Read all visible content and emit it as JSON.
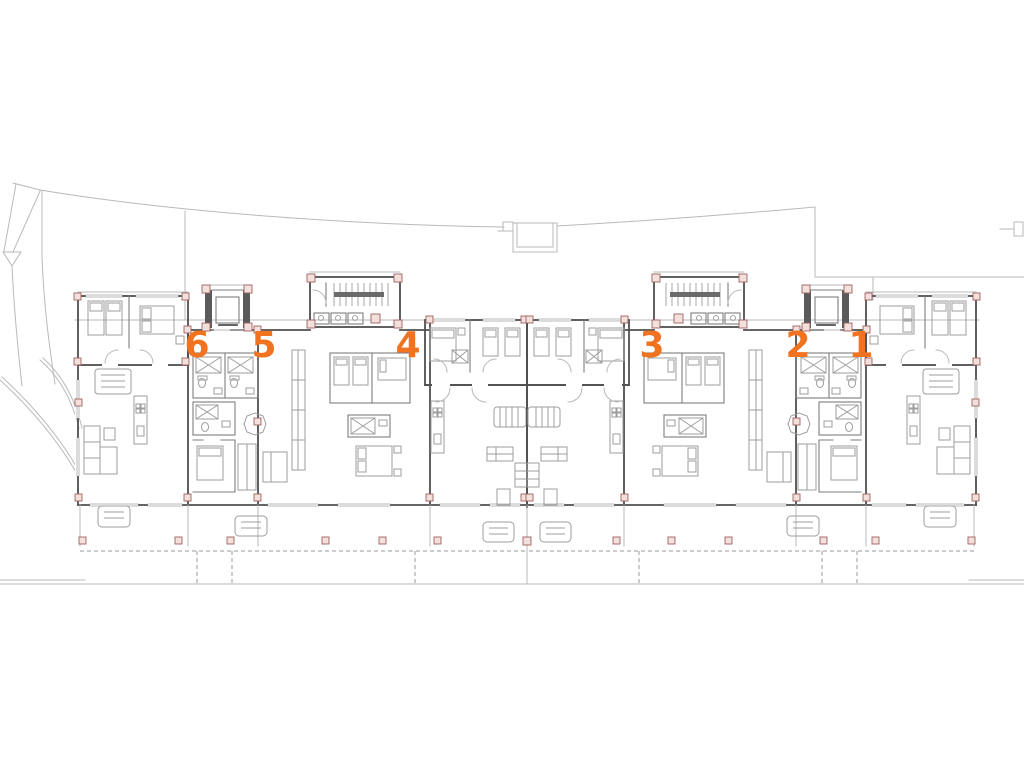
{
  "page": {
    "title": "apartment-building-floor-plan",
    "background": "#ffffff",
    "drawing_type": "architectural-floor-plan"
  },
  "plan": {
    "units": [
      {
        "id": "unit-6",
        "number": "6"
      },
      {
        "id": "unit-5",
        "number": "5"
      },
      {
        "id": "unit-4",
        "number": "4"
      },
      {
        "id": "unit-3",
        "number": "3"
      },
      {
        "id": "unit-2",
        "number": "2"
      },
      {
        "id": "unit-1",
        "number": "1"
      }
    ],
    "unit_sequence_left_to_right": "6 5 4 3 2 1",
    "colors": {
      "unit_number": "#f1731f",
      "wall": "#4f4f4f",
      "partition": "#7e7e7e",
      "site_line": "#b9b9b9",
      "furniture": "#9d9d9d",
      "column_pad_fill": "#f2e0dc",
      "column_pad_stroke": "#a06060",
      "terrace_dash": "#9a9a9a"
    }
  }
}
